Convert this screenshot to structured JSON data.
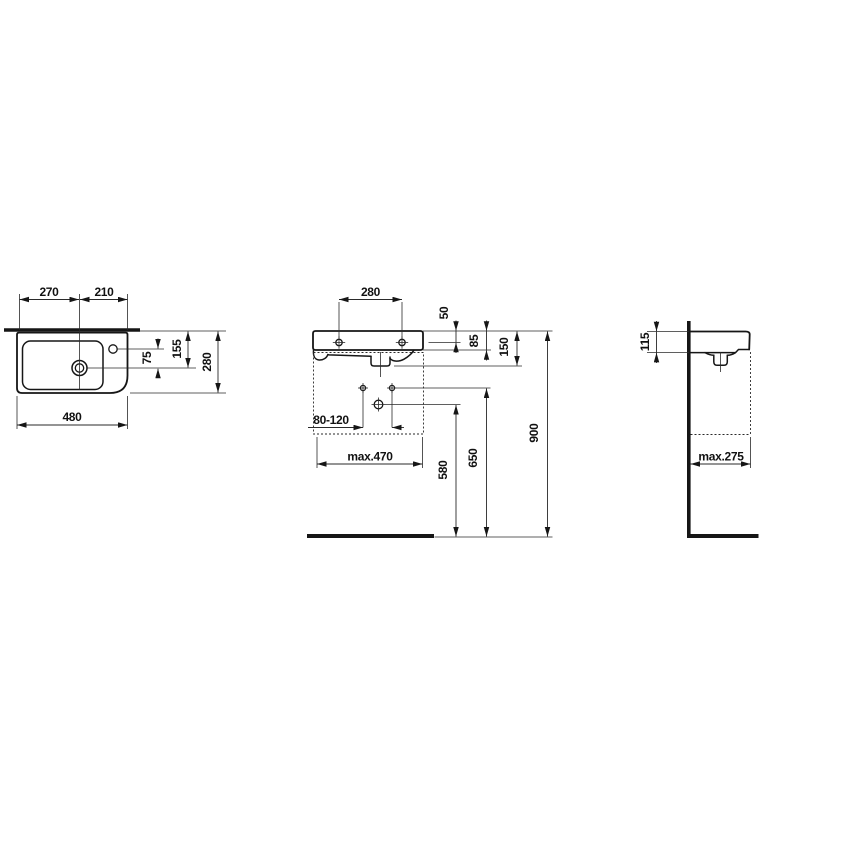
{
  "drawing": {
    "kind": "wall-hung handrinse washbasin — dimensional technical drawing",
    "colors": {
      "line": "#161616",
      "text": "#111111",
      "background": "#ffffff"
    }
  },
  "top_view": {
    "dim_drain_from_left": "270",
    "dim_drain_from_right": "210",
    "dim_total_width": "480",
    "dim_total_depth": "280",
    "dim_drain_from_rear": "155",
    "dim_taphole_to_drain": "75"
  },
  "front_view": {
    "dim_hole_spacing": "280",
    "dim_rim_to_holes": "50",
    "dim_rim_to_apron": "85",
    "dim_rim_to_outlet": "150",
    "dim_anchor_range": "80-120",
    "dim_max_width": "max.470",
    "dim_outlet_height": "580",
    "dim_anchor_height": "650",
    "dim_rim_height": "900"
  },
  "side_view": {
    "dim_rim_thickness": "115",
    "dim_max_depth": "max.275"
  }
}
